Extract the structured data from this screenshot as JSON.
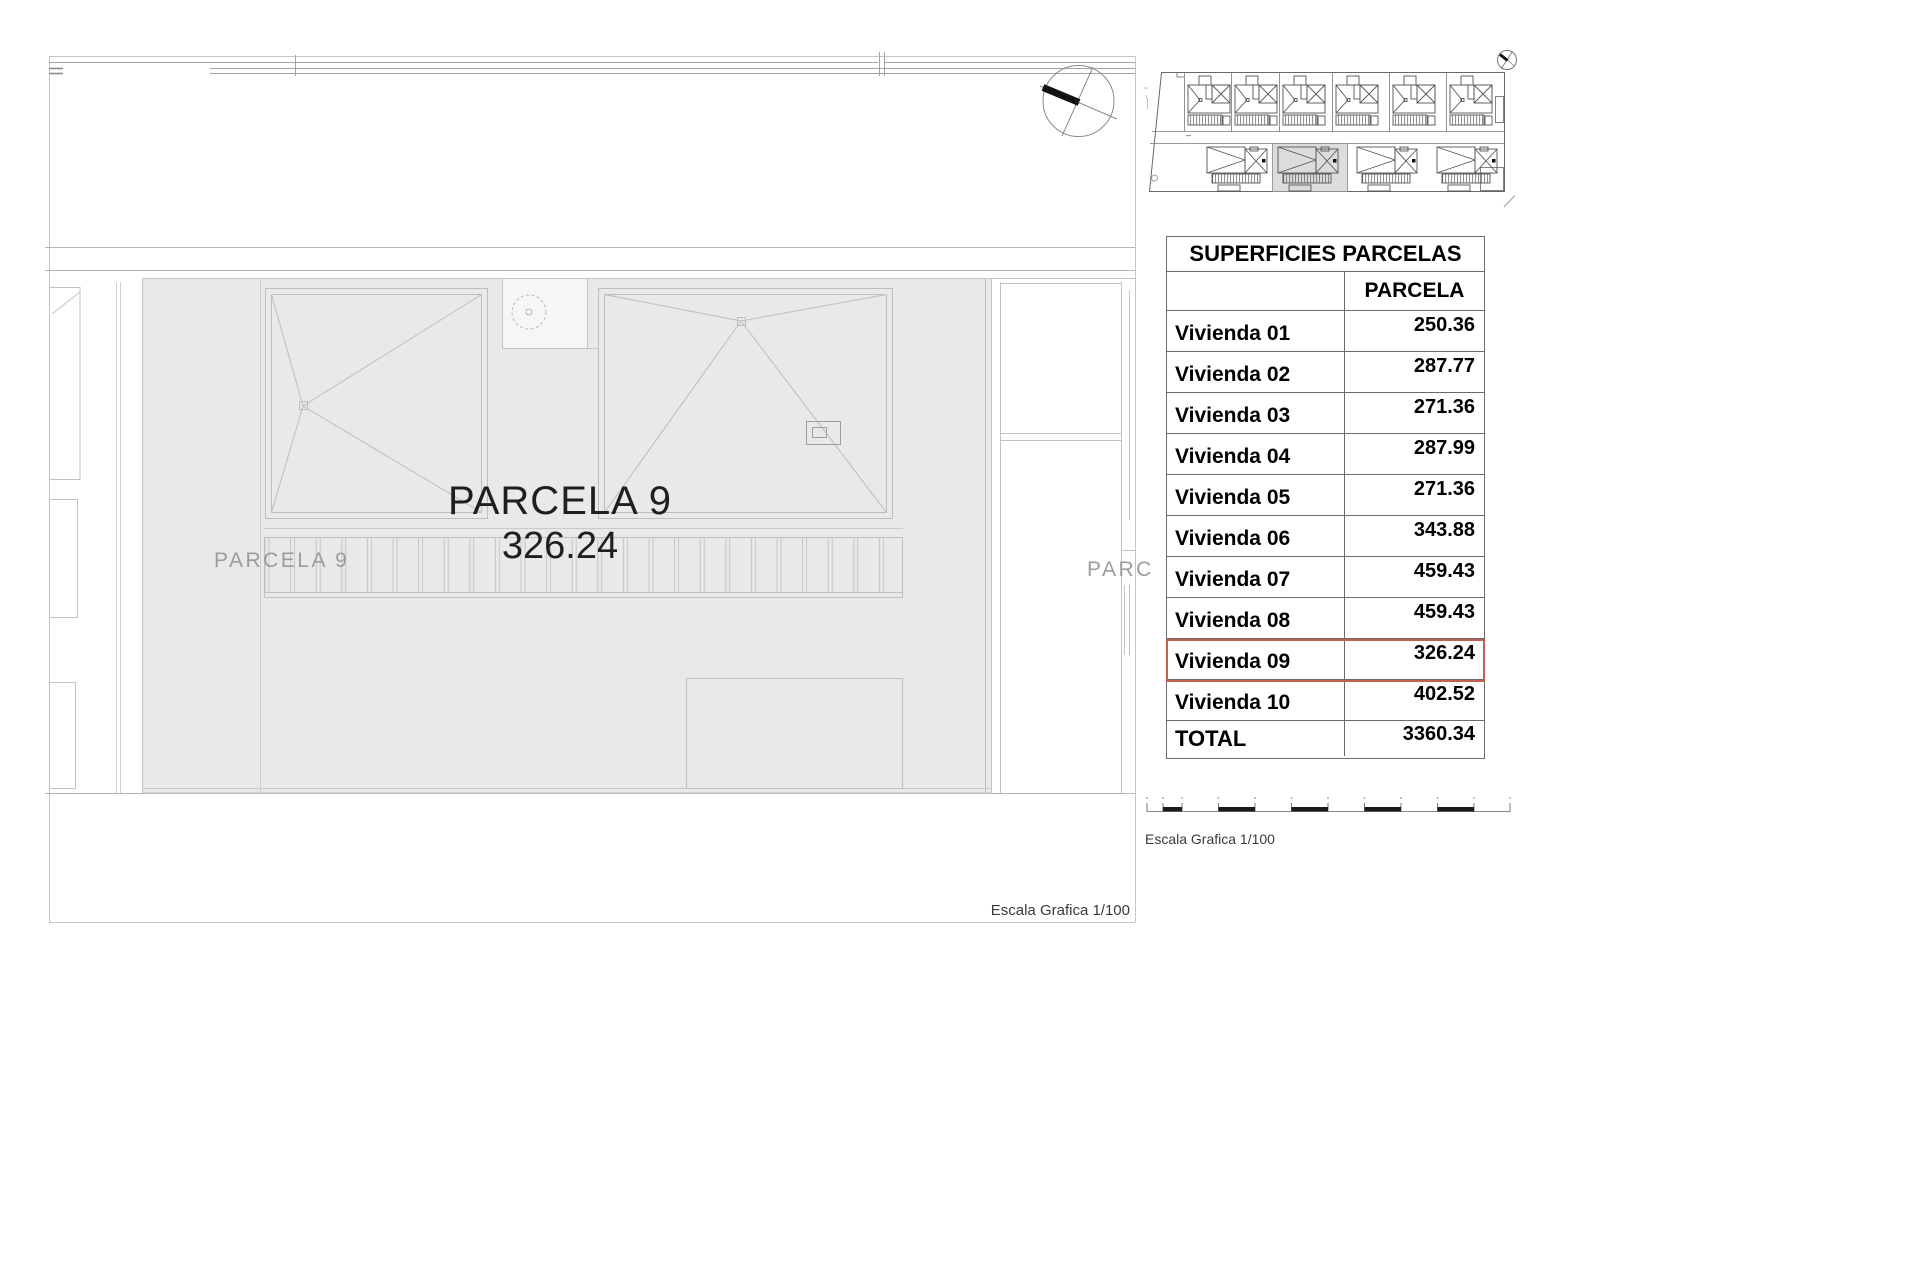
{
  "colors": {
    "highlight_red": "#c4604f",
    "parcel_fill": "#e9e9e9",
    "table_line": "#6a6a6a"
  },
  "main_drawing": {
    "parcel_label_large": "PARCELA 9",
    "parcel_area_large": "326.24",
    "parcel_label_small": "PARCELA 9",
    "neighbor_parcel_label_clipped": "PARC",
    "scale_caption": "Escala Grafica 1/100"
  },
  "side_panel": {
    "table": {
      "title": "SUPERFICIES PARCELAS",
      "value_column_header": "PARCELA",
      "rows": [
        {
          "label": "Vivienda 01",
          "value": "250.36"
        },
        {
          "label": "Vivienda 02",
          "value": "287.77"
        },
        {
          "label": "Vivienda 03",
          "value": "271.36"
        },
        {
          "label": "Vivienda 04",
          "value": "287.99"
        },
        {
          "label": "Vivienda 05",
          "value": "271.36"
        },
        {
          "label": "Vivienda 06",
          "value": "343.88"
        },
        {
          "label": "Vivienda 07",
          "value": "459.43"
        },
        {
          "label": "Vivienda 08",
          "value": "459.43"
        },
        {
          "label": "Vivienda 09",
          "value": "326.24",
          "highlighted": true
        },
        {
          "label": "Vivienda 10",
          "value": "402.52"
        }
      ],
      "total_row": {
        "label": "TOTAL",
        "value": "3360.34"
      },
      "highlighted_row_label": "Vivienda 09"
    },
    "scale_caption": "Escala Grafica 1/100"
  }
}
